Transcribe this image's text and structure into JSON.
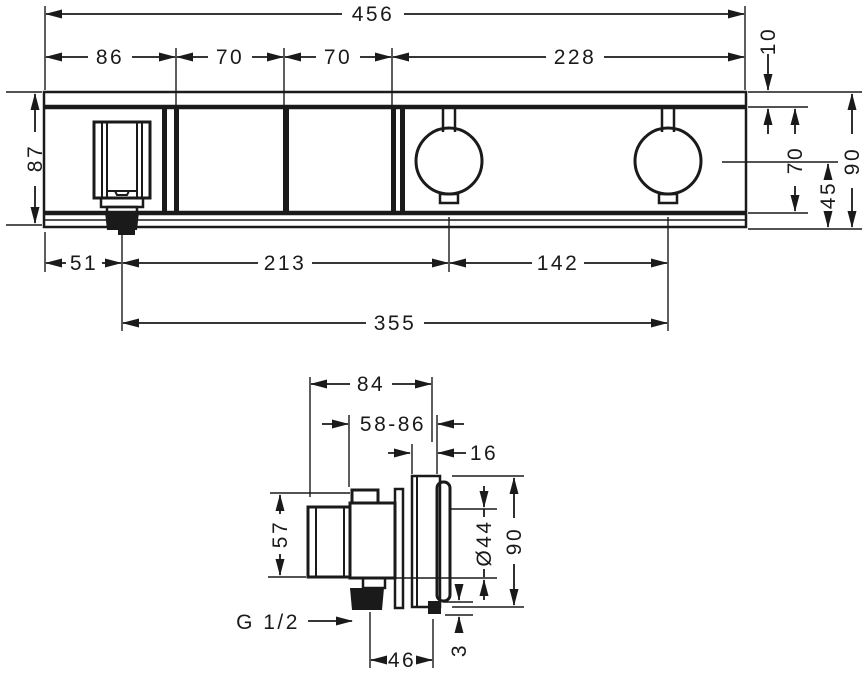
{
  "drawing": {
    "kind": "thermostat-module technical dimension drawing",
    "line_color": "#1a1a1a",
    "background_color": "#ffffff"
  },
  "front_view": {
    "overall_width": "456",
    "module_1_width": "86",
    "module_2_width": "70",
    "module_3_width": "70",
    "module_4_width": "228",
    "top_edge_offset": "10",
    "panel_height": "87",
    "body_height_right": "70",
    "handle_center_to_bottom": "45",
    "overall_height_right": "90",
    "outlet_center_from_left": "51",
    "outlet_to_handle_1": "213",
    "handle_spacing": "142",
    "outlet_to_handle_2": "355"
  },
  "side_view": {
    "overall_depth": "84",
    "installation_depth_range": "58-86",
    "escutcheon_thickness": "16",
    "body_height": "57",
    "handle_diameter": "Ø44",
    "escutcheon_height": "90",
    "thread_size": "G 1/2",
    "outlet_axis_to_front": "46",
    "wall_standoff": "3"
  }
}
